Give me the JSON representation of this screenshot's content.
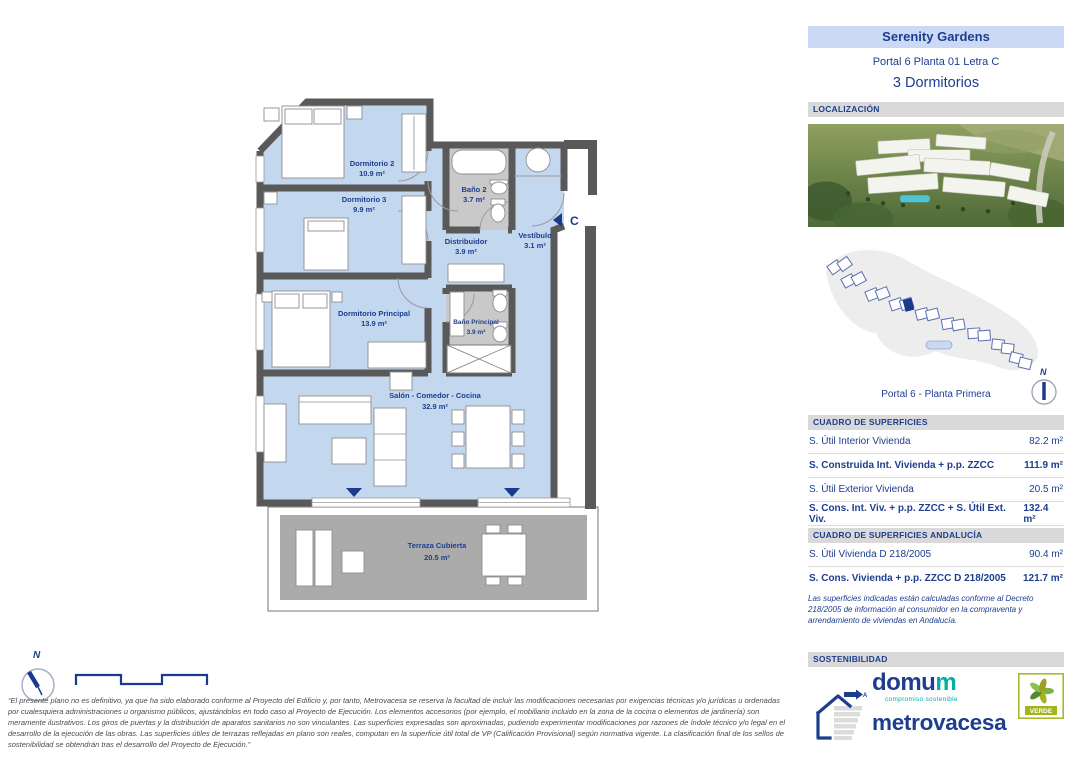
{
  "header": {
    "project": "Serenity Gardens",
    "unit": "Portal 6 Planta 01 Letra C",
    "type": "3 Dormitorios"
  },
  "sections": {
    "location": "LOCALIZACIÓN",
    "surfaces": "CUADRO DE SUPERFICIES",
    "surfaces_andalucia": "CUADRO DE SUPERFICIES ANDALUCÍA",
    "sustainability": "SOSTENIBILIDAD"
  },
  "site_plan": {
    "caption": "Portal 6 - Planta Primera"
  },
  "compass": {
    "north": "N"
  },
  "floor_plan": {
    "entrance_label": "C",
    "rooms": [
      {
        "name": "Dormitorio 2",
        "area": "10.9 m²"
      },
      {
        "name": "Dormitorio 3",
        "area": "9.9 m²"
      },
      {
        "name": "Baño 2",
        "area": "3.7 m²"
      },
      {
        "name": "Distribuidor",
        "area": "3.9 m²"
      },
      {
        "name": "Vestíbulo",
        "area": "3.1 m²"
      },
      {
        "name": "Dormitorio Principal",
        "area": "13.9 m²"
      },
      {
        "name": "Baño Principal",
        "area": "3.9 m²"
      },
      {
        "name": "Salón - Comedor - Cocina",
        "area": "32.9 m²"
      },
      {
        "name": "Terraza Cubierta",
        "area": "20.5 m²"
      }
    ]
  },
  "surfaces_table": {
    "rows": [
      {
        "label": "S. Útil Interior Vivienda",
        "value": "82.2 m²"
      },
      {
        "label": "S. Construida Int. Vivienda + p.p. ZZCC",
        "value": "111.9 m²"
      },
      {
        "label": "S. Útil Exterior Vivienda",
        "value": "20.5 m²"
      },
      {
        "label": "S. Cons. Int. Viv. + p.p. ZZCC + S. Útil Ext. Viv.",
        "value": "132.4 m²"
      }
    ]
  },
  "andalucia_table": {
    "rows": [
      {
        "label": "S. Útil Vivienda D 218/2005",
        "value": "90.4 m²"
      },
      {
        "label": "S. Cons. Vivienda + p.p. ZZCC D 218/2005",
        "value": "121.7 m²"
      }
    ],
    "note": "Las superficies indicadas están calculadas conforme al Decreto 218/2005 de información al consumidor en la compraventa y arrendamiento de viviendas en Andalucía."
  },
  "disclaimer": "“El presente plano no es definitivo, ya que ha sido elaborado conforme al Proyecto del Edificio y, por tanto, Metrovacesa se reserva la facultad de incluir las modificaciones necesarias por exigencias técnicas y/o jurídicas u ordenadas por cualesquiera administraciones u organismo públicos, ajustándolos en todo caso al Proyecto de Ejecución. Los elementos accesorios (por ejemplo, el mobiliario incluido en la zona de la cocina o elementos de jardinería) son meramente ilustrativos. Los giros de puertas y la distribución de aparatos sanitarios no son vinculantes. Las superficies expresadas son aproximadas, pudiendo experimentar modificaciones por razones de índole técnico y/o legal en el desarrollo de la ejecución de las obras. Las superficies útiles de terrazas reflejadas en plano son reales, computan en la superficie útil total de VP (Calificación Provisional) según normativa vigente. La clasificación final de los sellos de sostenibilidad se obtendrán tras el desarrollo del Proyecto de Ejecución.”",
  "logos": {
    "domum_main": "domu",
    "domum_last": "m",
    "domum_subtitle": "compromiso sostenible",
    "metrovacesa": "metrovacesa",
    "verde": "VERDE",
    "energy_class": "A"
  },
  "colors": {
    "navy": "#1D3E8F",
    "teal": "#00AFA5",
    "olive": "#A3B41F",
    "room_blue": "#C3D7EF",
    "wall_gray": "#595959",
    "bar_gray": "#D9D9D9",
    "title_bg": "#CBD9F4"
  }
}
